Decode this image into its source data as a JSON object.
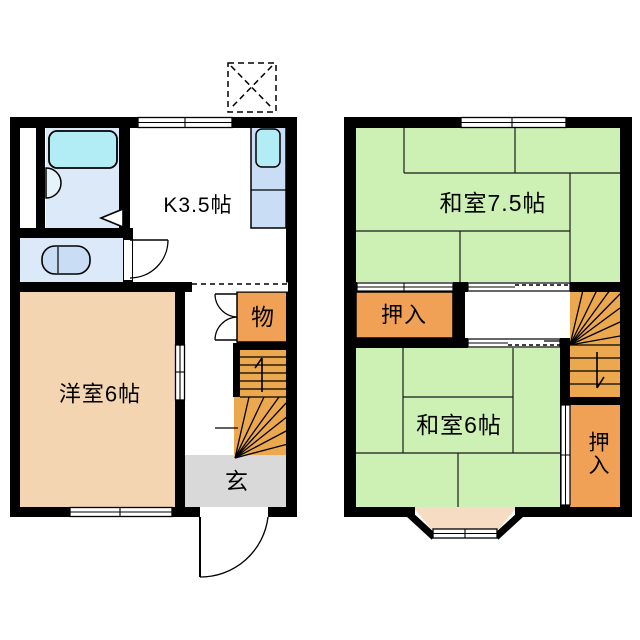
{
  "image_type": "apartment-floor-plan",
  "floors": {
    "first": {
      "rooms": {
        "kitchen": "K3.5帖",
        "western_room": "洋室6帖",
        "storage": "物",
        "entrance": "玄"
      }
    },
    "second": {
      "rooms": {
        "japanese_room_large": "和室7.5帖",
        "closet_upper": "押入",
        "japanese_room_small": "和室6帖",
        "closet_lower": "押入"
      }
    }
  },
  "palette": {
    "wall": "#000000",
    "tatami_green": "#cdf1b5",
    "wood_peach": "#f4d5b2",
    "closet_orange": "#f0a156",
    "stairs_orange": "#eba84f",
    "water_blue": "#dce9f8",
    "fixture_blue": "#c9def5",
    "tub_cyan": "#b2edf5",
    "entrance_gray": "#d9d9d9",
    "bay_peach": "#f7dcc4"
  }
}
